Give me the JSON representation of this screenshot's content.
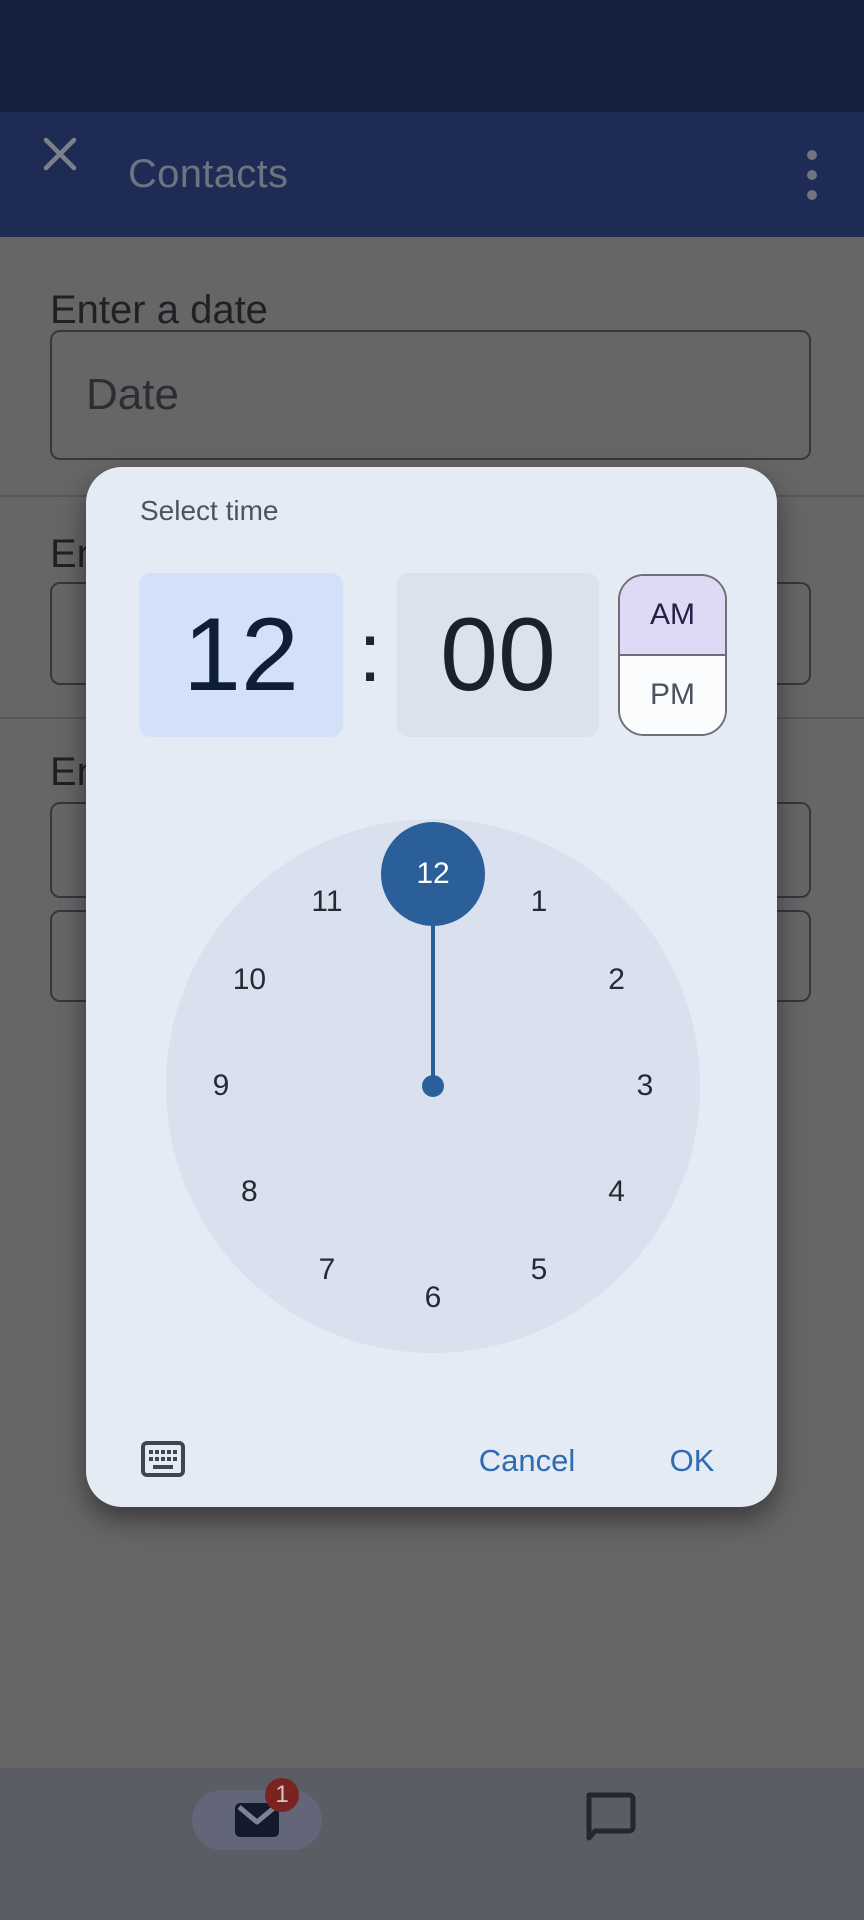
{
  "app_bar": {
    "title": "Contacts"
  },
  "form": {
    "date_label": "Enter a date",
    "date_placeholder": "Date",
    "partial_label_top": "En",
    "partial_label_bottom": "En"
  },
  "time_picker": {
    "title": "Select time",
    "hour": "12",
    "minute": "00",
    "separator": ":",
    "period": {
      "am": "AM",
      "pm": "PM",
      "selected": "AM"
    },
    "clock": {
      "numbers": [
        "1",
        "2",
        "3",
        "4",
        "5",
        "6",
        "7",
        "8",
        "9",
        "10",
        "11",
        "12"
      ],
      "selected": "12"
    },
    "actions": {
      "cancel": "Cancel",
      "ok": "OK"
    }
  },
  "bottom_nav": {
    "mail_badge": "1"
  },
  "colors": {
    "status_bar_navy": "#15213e",
    "app_bar_blue": "#1e2c55",
    "accent_blue": "#2b5f9a",
    "hour_cell_bg": "#d3e1f8",
    "am_highlight": "#ded9f4",
    "dial_bg": "#d9e0ee",
    "action_blue": "#2e6bb2",
    "badge_red": "#7b2321",
    "dialog_bg": "#e4ebf4"
  }
}
